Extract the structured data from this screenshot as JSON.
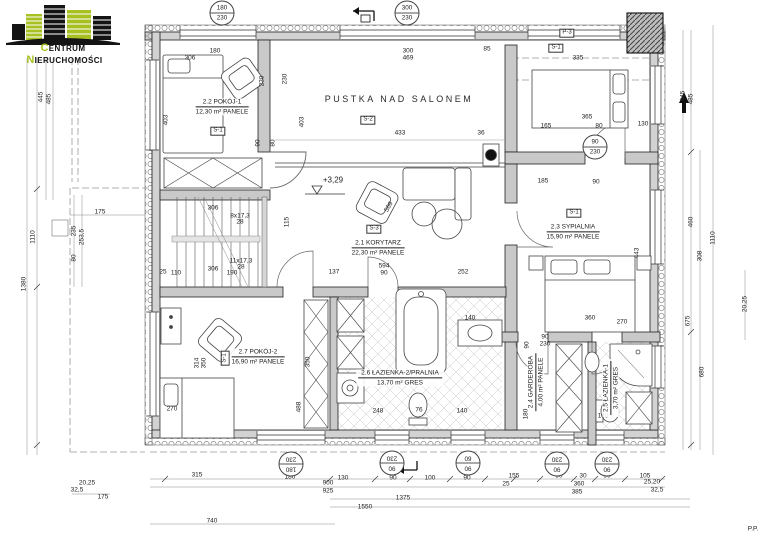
{
  "logo": {
    "word1": "Centrum",
    "word2": "Nieruchomości",
    "accent": "#a9c023"
  },
  "rooms": [
    {
      "id": "2.2",
      "name": "POKÓJ-1",
      "area": "12,30 m²",
      "floor": "PANELE",
      "x": 222,
      "y": 107
    },
    {
      "id": "2.1",
      "name": "KORYTARZ",
      "area": "22,30 m²",
      "floor": "PANELE",
      "x": 378,
      "y": 248
    },
    {
      "id": "2.3",
      "name": "SYPIALNIA",
      "area": "15,90 m²",
      "floor": "PANELE",
      "x": 573,
      "y": 232
    },
    {
      "id": "2.7",
      "name": "POKÓJ-2",
      "area": "16,90 m²",
      "floor": "PANELE",
      "x": 258,
      "y": 357
    },
    {
      "id": "2.6",
      "name": "ŁAZIENKA-2/PRALNIA",
      "area": "13,70 m²",
      "floor": "GRES",
      "x": 400,
      "y": 378
    },
    {
      "id": "2.4",
      "name": "GARDEROBA",
      "area": "4,00 m²",
      "floor": "PANELE",
      "x": 536,
      "y": 382,
      "rot": -90
    },
    {
      "id": "2.5",
      "name": "ŁAZIENKA-1",
      "area": "3,70 m²",
      "floor": "GRES",
      "x": 611,
      "y": 388,
      "rot": -90
    }
  ],
  "annotations": [
    {
      "t": "PUSTKA NAD SALONEM",
      "x": 399,
      "y": 100,
      "cls": "void-label",
      "name": "void-over-living-room-label"
    },
    {
      "t": "+3,29",
      "x": 333,
      "y": 181,
      "cls": "level",
      "name": "level-marker-text"
    },
    {
      "t": "569",
      "x": 389,
      "y": 207,
      "rot": -60,
      "cls": "dim",
      "name": "dimension-label"
    },
    {
      "t": "S-1",
      "x": 218,
      "y": 131,
      "cls": "flag",
      "name": "section-marker-s1"
    },
    {
      "t": "S-2",
      "x": 368,
      "y": 120,
      "cls": "flag",
      "name": "section-marker-s2"
    },
    {
      "t": "S-3",
      "x": 374,
      "y": 229,
      "cls": "flag",
      "name": "section-marker-s3"
    },
    {
      "t": "S-1",
      "x": 574,
      "y": 213,
      "cls": "flag",
      "name": "section-marker-s1"
    },
    {
      "t": "S-1",
      "x": 225,
      "y": 358,
      "rot": -90,
      "cls": "flag",
      "name": "section-marker-s1"
    },
    {
      "t": "S-1",
      "x": 556,
      "y": 48,
      "cls": "flag",
      "name": "section-marker-s1"
    },
    {
      "t": "P-3",
      "x": 567,
      "y": 33,
      "cls": "flag",
      "name": "panel-marker-p3"
    },
    {
      "t": "P.P.",
      "x": 753,
      "y": 529,
      "cls": "dim",
      "name": "corner-note"
    }
  ],
  "window_tags": [
    {
      "w": "180",
      "h": "230",
      "x": 222,
      "y": 13
    },
    {
      "w": "300",
      "h": "230",
      "x": 407,
      "y": 13
    },
    {
      "w": "90",
      "h": "230",
      "x": 595,
      "y": 147
    },
    {
      "w": "180",
      "h": "230",
      "x": 291,
      "y": 464,
      "rot": 180
    },
    {
      "w": "90",
      "h": "230",
      "x": 392,
      "y": 463,
      "rot": 180
    },
    {
      "w": "90",
      "h": "60",
      "x": 468,
      "y": 463,
      "rot": 180
    },
    {
      "w": "90",
      "h": "230",
      "x": 557,
      "y": 464,
      "rot": 180
    },
    {
      "w": "90",
      "h": "230",
      "x": 607,
      "y": 464,
      "rot": 180
    }
  ],
  "dims": [
    {
      "t": "180",
      "x": 215,
      "y": 51
    },
    {
      "t": "306",
      "x": 190,
      "y": 58
    },
    {
      "t": "300",
      "x": 408,
      "y": 51
    },
    {
      "t": "469",
      "x": 408,
      "y": 58
    },
    {
      "t": "85",
      "x": 487,
      "y": 49
    },
    {
      "t": "335",
      "x": 578,
      "y": 58
    },
    {
      "t": "365",
      "x": 587,
      "y": 117
    },
    {
      "t": "130",
      "x": 643,
      "y": 124
    },
    {
      "t": "165",
      "x": 546,
      "y": 126
    },
    {
      "t": "80",
      "x": 599,
      "y": 126
    },
    {
      "t": "433",
      "x": 400,
      "y": 133
    },
    {
      "t": "36",
      "x": 481,
      "y": 133
    },
    {
      "t": "185",
      "x": 543,
      "y": 181
    },
    {
      "t": "90",
      "x": 596,
      "y": 182
    },
    {
      "t": "230",
      "x": 262,
      "y": 81,
      "rot": -90
    },
    {
      "t": "230",
      "x": 285,
      "y": 79,
      "rot": -90
    },
    {
      "t": "403",
      "x": 166,
      "y": 120,
      "rot": -90
    },
    {
      "t": "403",
      "x": 302,
      "y": 122,
      "rot": -90
    },
    {
      "t": "90",
      "x": 258,
      "y": 143,
      "rot": -90
    },
    {
      "t": "80",
      "x": 273,
      "y": 143,
      "rot": -90
    },
    {
      "t": "137",
      "x": 334,
      "y": 272
    },
    {
      "t": "594",
      "x": 384,
      "y": 266
    },
    {
      "t": "90",
      "x": 384,
      "y": 273
    },
    {
      "t": "252",
      "x": 463,
      "y": 272
    },
    {
      "t": "306",
      "x": 213,
      "y": 208
    },
    {
      "t": "8x17,3",
      "x": 240,
      "y": 216
    },
    {
      "t": "28",
      "x": 240,
      "y": 222
    },
    {
      "t": "11x17,3",
      "x": 241,
      "y": 261
    },
    {
      "t": "28",
      "x": 241,
      "y": 267
    },
    {
      "t": "306",
      "x": 213,
      "y": 269
    },
    {
      "t": "110",
      "x": 176,
      "y": 273
    },
    {
      "t": "190",
      "x": 232,
      "y": 273
    },
    {
      "t": "25",
      "x": 163,
      "y": 272
    },
    {
      "t": "115",
      "x": 287,
      "y": 222,
      "rot": -90
    },
    {
      "t": "443",
      "x": 637,
      "y": 253,
      "rot": -90
    },
    {
      "t": "360",
      "x": 590,
      "y": 318
    },
    {
      "t": "270",
      "x": 622,
      "y": 322
    },
    {
      "t": "314",
      "x": 197,
      "y": 363,
      "rot": -90
    },
    {
      "t": "350",
      "x": 204,
      "y": 363,
      "rot": -90
    },
    {
      "t": "350",
      "x": 308,
      "y": 362,
      "rot": -90
    },
    {
      "t": "270",
      "x": 172,
      "y": 409
    },
    {
      "t": "488",
      "x": 299,
      "y": 407,
      "rot": -90
    },
    {
      "t": "248",
      "x": 378,
      "y": 411
    },
    {
      "t": "76",
      "x": 419,
      "y": 410
    },
    {
      "t": "140",
      "x": 462,
      "y": 411
    },
    {
      "t": "140",
      "x": 470,
      "y": 318
    },
    {
      "t": "90",
      "x": 527,
      "y": 345,
      "rot": -90
    },
    {
      "t": "180",
      "x": 526,
      "y": 414,
      "rot": -90
    },
    {
      "t": "90",
      "x": 545,
      "y": 337
    },
    {
      "t": "230",
      "x": 545,
      "y": 344
    },
    {
      "t": "140",
      "x": 603,
      "y": 416
    },
    {
      "t": "445",
      "x": 41,
      "y": 97,
      "rot": -90
    },
    {
      "t": "485",
      "x": 49,
      "y": 99,
      "rot": -90
    },
    {
      "t": "1110",
      "x": 33,
      "y": 237,
      "rot": -90
    },
    {
      "t": "1380",
      "x": 24,
      "y": 284,
      "rot": -90
    },
    {
      "t": "175",
      "x": 100,
      "y": 212
    },
    {
      "t": "235",
      "x": 74,
      "y": 231,
      "rot": -90
    },
    {
      "t": "253,5",
      "x": 82,
      "y": 237,
      "rot": -90
    },
    {
      "t": "80",
      "x": 74,
      "y": 258,
      "rot": -90
    },
    {
      "t": "445",
      "x": 683,
      "y": 96,
      "rot": -90
    },
    {
      "t": "485",
      "x": 691,
      "y": 99,
      "rot": -90
    },
    {
      "t": "1110",
      "x": 713,
      "y": 238,
      "rot": -90
    },
    {
      "t": "460",
      "x": 691,
      "y": 222,
      "rot": -90
    },
    {
      "t": "308",
      "x": 700,
      "y": 256,
      "rot": -90
    },
    {
      "t": "675",
      "x": 688,
      "y": 321,
      "rot": -90
    },
    {
      "t": "680",
      "x": 702,
      "y": 372,
      "rot": -90
    },
    {
      "t": "20,25",
      "x": 745,
      "y": 304,
      "rot": -90
    },
    {
      "t": "315",
      "x": 197,
      "y": 475
    },
    {
      "t": "180",
      "x": 290,
      "y": 477
    },
    {
      "t": "20,25",
      "x": 87,
      "y": 483
    },
    {
      "t": "32,5",
      "x": 77,
      "y": 490
    },
    {
      "t": "175",
      "x": 103,
      "y": 497
    },
    {
      "t": "740",
      "x": 212,
      "y": 521
    },
    {
      "t": "130",
      "x": 343,
      "y": 478
    },
    {
      "t": "90",
      "x": 393,
      "y": 478
    },
    {
      "t": "100",
      "x": 430,
      "y": 478
    },
    {
      "t": "90",
      "x": 467,
      "y": 478
    },
    {
      "t": "155",
      "x": 514,
      "y": 476
    },
    {
      "t": "25",
      "x": 506,
      "y": 484
    },
    {
      "t": "90",
      "x": 559,
      "y": 476
    },
    {
      "t": "30",
      "x": 583,
      "y": 476
    },
    {
      "t": "90",
      "x": 607,
      "y": 476
    },
    {
      "t": "105",
      "x": 645,
      "y": 476
    },
    {
      "t": "900",
      "x": 328,
      "y": 483
    },
    {
      "t": "925",
      "x": 328,
      "y": 491
    },
    {
      "t": "360",
      "x": 579,
      "y": 484
    },
    {
      "t": "385",
      "x": 577,
      "y": 492
    },
    {
      "t": "1375",
      "x": 403,
      "y": 498
    },
    {
      "t": "1550",
      "x": 365,
      "y": 507
    },
    {
      "t": "25,20",
      "x": 652,
      "y": 482
    },
    {
      "t": "32,5",
      "x": 657,
      "y": 490
    }
  ]
}
